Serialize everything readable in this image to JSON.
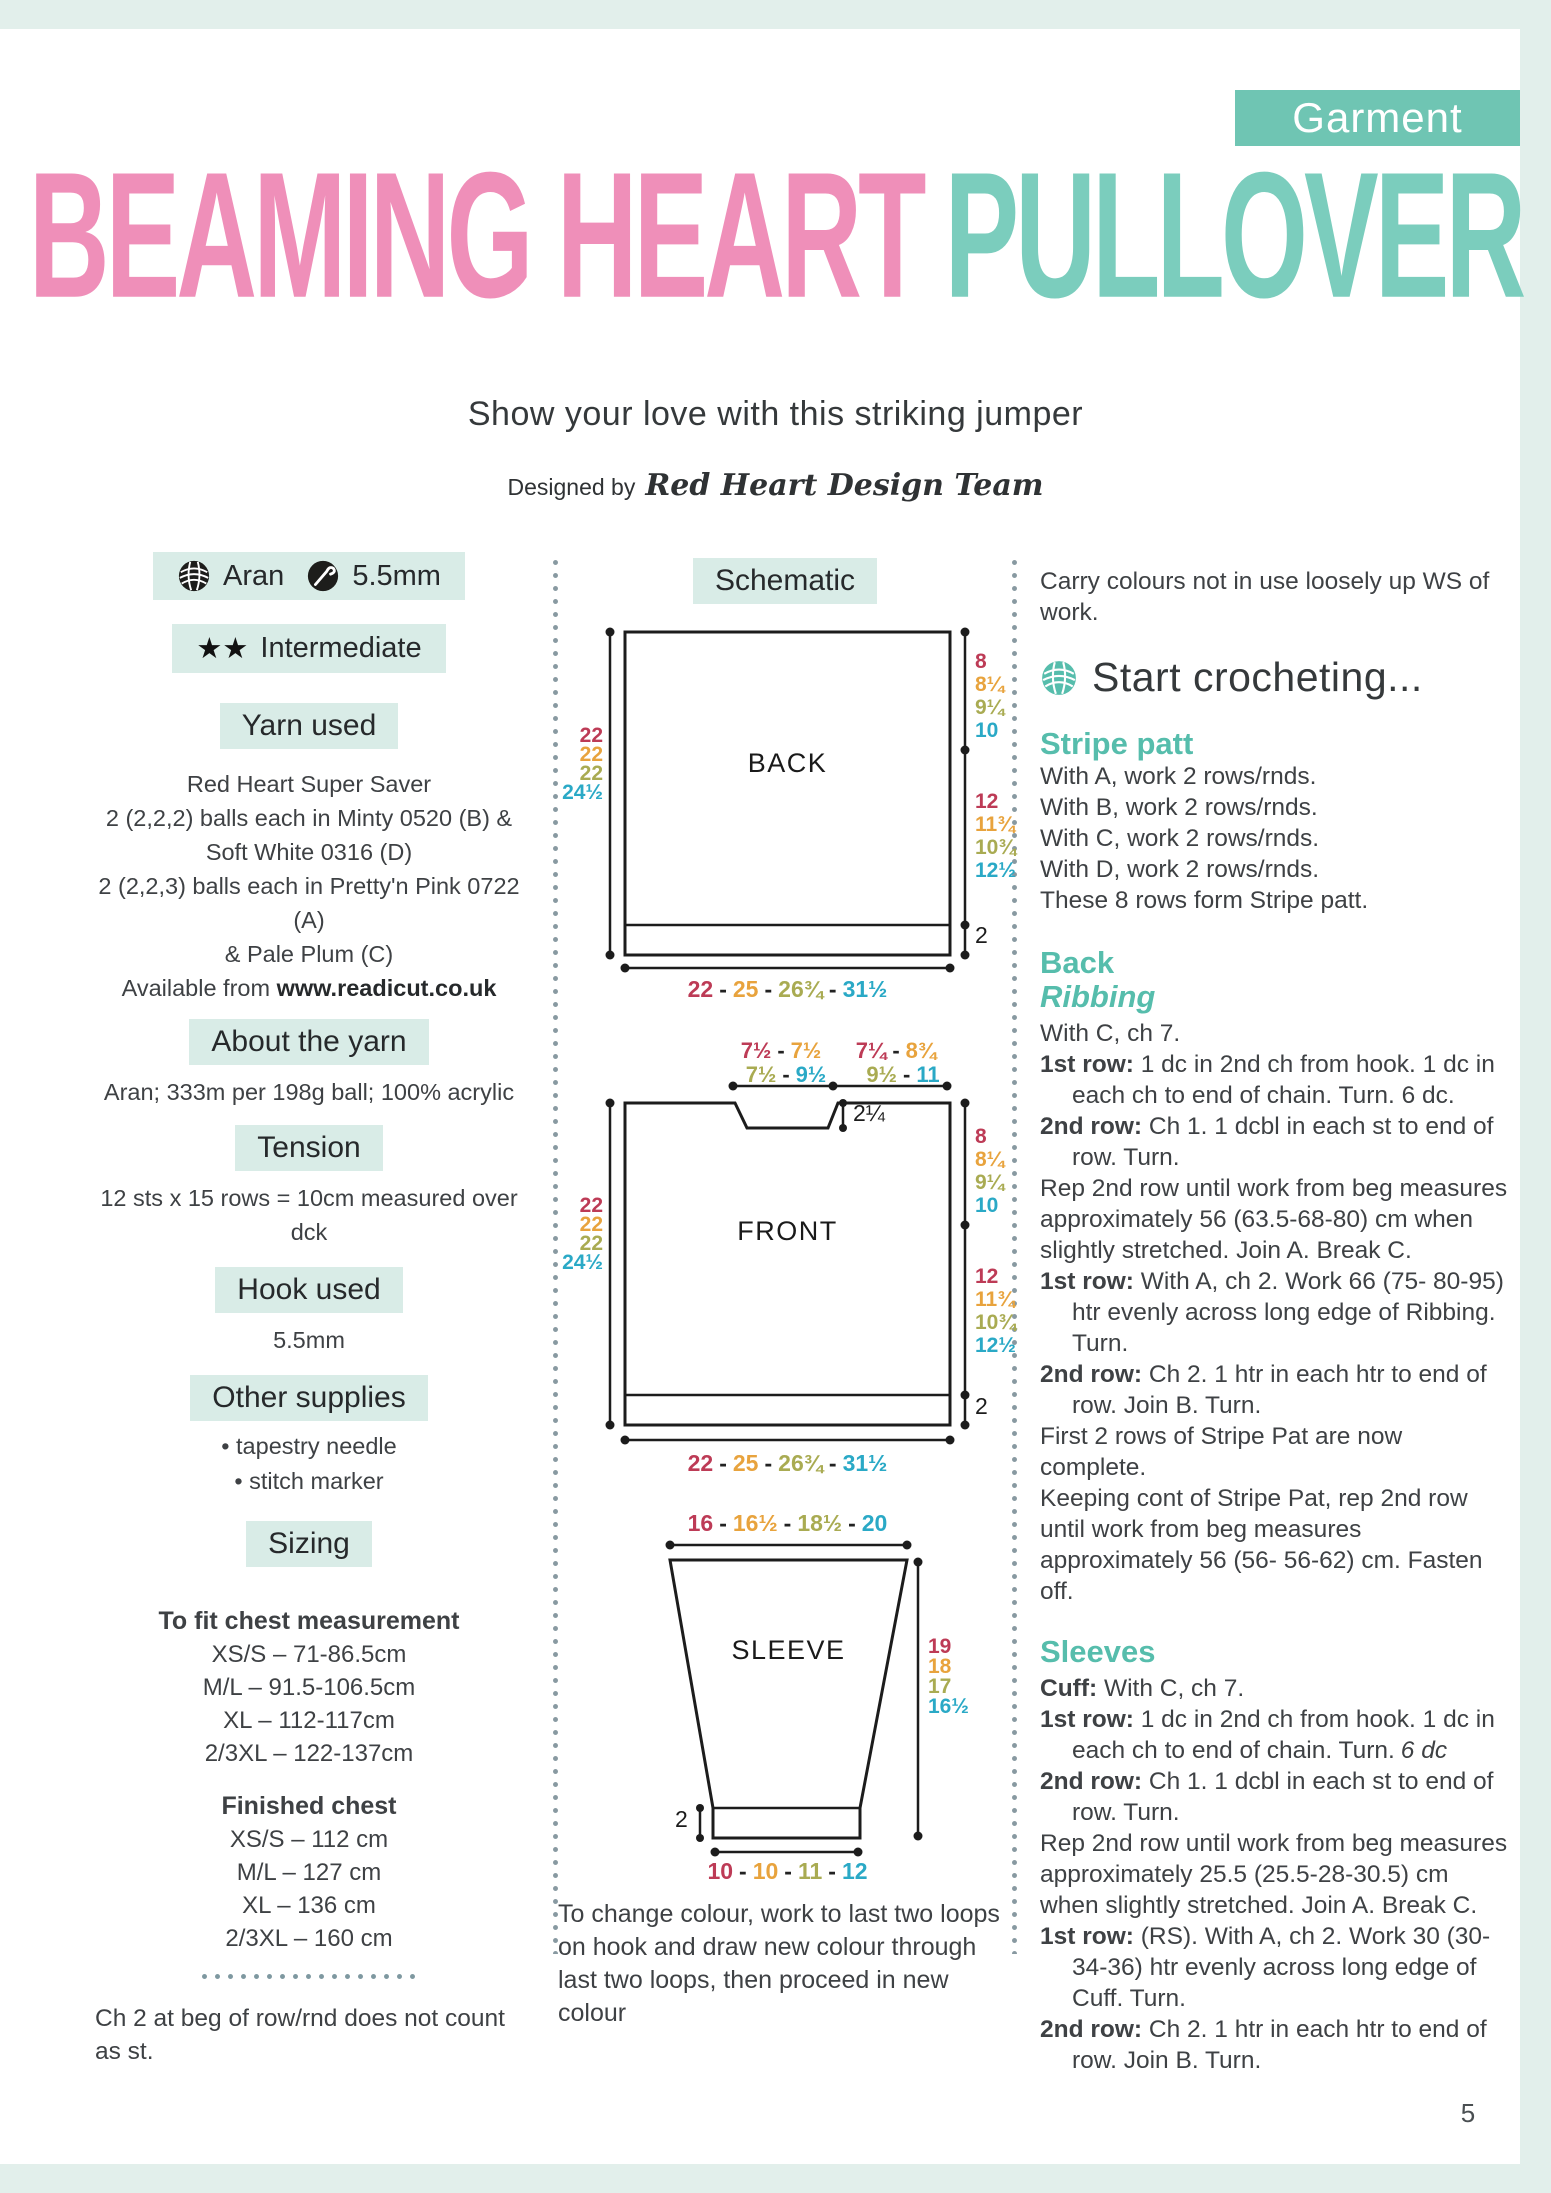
{
  "page_number": "5",
  "badge": {
    "label": "Garment"
  },
  "title": {
    "part1": "BEAMING HEART",
    "part2": "PULLOVER"
  },
  "subtitle": "Show your love with this striking jumper",
  "designed_by": {
    "prefix": "Designed by",
    "name": "Red Heart Design Team"
  },
  "left": {
    "yarn_badge": {
      "yarn_weight": "Aran",
      "hook_size": "5.5mm"
    },
    "skill": {
      "stars": "★★",
      "level": "Intermediate"
    },
    "yarn_used": {
      "heading": "Yarn used",
      "lines": [
        "Red Heart Super Saver",
        "2 (2,2,2) balls each in Minty 0520 (B) &",
        "Soft White 0316 (D)",
        "2 (2,2,3) balls each in Pretty'n Pink 0722 (A)",
        "& Pale Plum (C)"
      ],
      "available_prefix": "Available from",
      "url": "www.readicut.co.uk"
    },
    "about": {
      "heading": "About the yarn",
      "text": "Aran; 333m per 198g ball; 100% acrylic"
    },
    "tension": {
      "heading": "Tension",
      "text": "12 sts x 15 rows = 10cm measured over dck"
    },
    "hook": {
      "heading": "Hook used",
      "text": "5.5mm"
    },
    "supplies": {
      "heading": "Other supplies",
      "bullet": "•",
      "items": [
        "tapestry needle",
        "stitch marker"
      ]
    },
    "sizing": {
      "heading": "Sizing",
      "fit_heading": "To fit chest measurement",
      "fit": [
        "XS/S – 71-86.5cm",
        "M/L – 91.5-106.5cm",
        "XL – 112-117cm",
        "2/3XL – 122-137cm"
      ],
      "finished_heading": "Finished chest",
      "finished": [
        "XS/S – 112 cm",
        "M/L – 127 cm",
        "XL – 136 cm",
        "2/3XL – 160 cm"
      ]
    },
    "note": "Ch 2 at beg of row/rnd does not count as st."
  },
  "schematic": {
    "heading": "Schematic",
    "dash": "-",
    "back": {
      "label": "BACK",
      "left_heights": [
        "22",
        "22",
        "22",
        "24½"
      ],
      "right_armhole": [
        "8",
        "8¼",
        "9¼",
        "10"
      ],
      "right_body": [
        "12",
        "11¾",
        "10¾",
        "12½"
      ],
      "rib_height": "2",
      "bottom_widths": [
        "22",
        "25",
        "26¾",
        "31½"
      ]
    },
    "front": {
      "label": "FRONT",
      "neck_top_row1": [
        "7½",
        "7½"
      ],
      "shoulder_top_row1": [
        "7¼",
        "8¾"
      ],
      "neck_top_row2": [
        "7½",
        "9½"
      ],
      "shoulder_top_row2": [
        "9½",
        "11"
      ],
      "neck_depth": "2¼",
      "left_heights": [
        "22",
        "22",
        "22",
        "24½"
      ],
      "right_armhole": [
        "8",
        "8¼",
        "9¼",
        "10"
      ],
      "right_body": [
        "12",
        "11¾",
        "10¾",
        "12½"
      ],
      "rib_height": "2",
      "bottom_widths": [
        "22",
        "25",
        "26¾",
        "31½"
      ]
    },
    "sleeve": {
      "label": "SLEEVE",
      "top_widths": [
        "16",
        "16½",
        "18½",
        "20"
      ],
      "right_heights": [
        "19",
        "18",
        "17",
        "16½"
      ],
      "cuff_height": "2",
      "bottom_widths": [
        "10",
        "10",
        "11",
        "12"
      ]
    },
    "colour_note": "To change colour, work to last two loops on hook and draw new colour through last two loops, then proceed in new colour"
  },
  "right": {
    "carry_note": "Carry colours not in use loosely up WS of work.",
    "start_heading": "Start crocheting...",
    "stripe": {
      "heading": "Stripe patt",
      "lines": [
        "With A, work 2 rows/rnds.",
        "With B, work 2 rows/rnds.",
        "With C, work 2 rows/rnds.",
        "With D, work 2 rows/rnds.",
        "These 8 rows form Stripe patt."
      ]
    },
    "back": {
      "heading": "Back",
      "subheading": "Ribbing",
      "paras": [
        {
          "text": "With C, ch 7."
        },
        {
          "label": "1st row:",
          "text": " 1 dc in 2nd ch from hook. 1 dc in each ch to end of chain. Turn. 6 dc."
        },
        {
          "label": "2nd row:",
          "text": " Ch 1. 1 dcbl in each st to end of row. Turn."
        },
        {
          "text": "Rep 2nd row until work from beg measures approximately 56 (63.5-68-80) cm when slightly stretched. Join A. Break C."
        },
        {
          "label": "1st row:",
          "text": " With A, ch 2. Work 66 (75- 80-95) htr evenly across long edge of Ribbing. Turn."
        },
        {
          "label": "2nd row:",
          "text": " Ch 2. 1 htr in each htr to end of row. Join B. Turn."
        },
        {
          "text": "First 2 rows of Stripe Pat are now complete."
        },
        {
          "text": "Keeping cont of Stripe Pat, rep 2nd row until work from beg measures approximately 56 (56- 56-62) cm. Fasten off."
        }
      ]
    },
    "sleeves": {
      "heading": "Sleeves",
      "paras": [
        {
          "label": "Cuff:",
          "text": " With C, ch 7."
        },
        {
          "label": "1st row:",
          "text": " 1 dc in 2nd ch from hook. 1 dc in each ch to end of chain. Turn.",
          "em": "6 dc"
        },
        {
          "label": "2nd row:",
          "text": " Ch 1. 1 dcbl in each st to end of row. Turn."
        },
        {
          "text": "Rep 2nd row until work from beg measures approximately 25.5 (25.5-28-30.5) cm when slightly stretched. Join A. Break C."
        },
        {
          "label": "1st row:",
          "text": " (RS). With A, ch 2. Work 30 (30- 34-36) htr evenly across long edge of Cuff. Turn."
        },
        {
          "label": "2nd row:",
          "text": " Ch 2. 1 htr in each htr to end of row. Join B. Turn."
        }
      ]
    }
  },
  "colors": {
    "title_pink": "#ef8fb9",
    "title_teal": "#7bcdbd",
    "badge_teal": "#6fc5b3",
    "mint_box": "#d9ece7",
    "band_mint": "#e2efeb",
    "heading_teal": "#56bdac",
    "size_xs_crimson": "#bd3b56",
    "size_ml_orange": "#e8a33d",
    "size_xl_olive": "#a9ab52",
    "size_2xl_blue": "#2aa9c6"
  },
  "icons": {
    "yarn_ball": "yarn-ball-icon",
    "crochet_hook": "crochet-hook-icon",
    "stars": "star-icons",
    "start_yarn_ball": "yarn-ball-teal-icon"
  }
}
